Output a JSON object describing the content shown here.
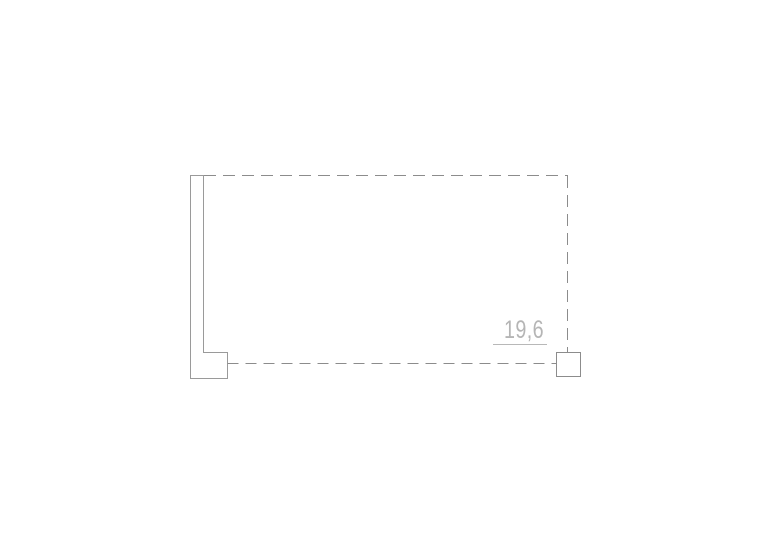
{
  "page": {
    "background": "#ffffff"
  },
  "drawing": {
    "dimension_label": "19,6",
    "colors": {
      "wall_stroke": "#9a9a9a",
      "dashed_stroke": "#8c8c8c",
      "column_stroke": "#8c8c8c",
      "dimension_line": "#b8b8b8",
      "dimension_text": "#b5b5b5",
      "fill": "#ffffff"
    }
  }
}
